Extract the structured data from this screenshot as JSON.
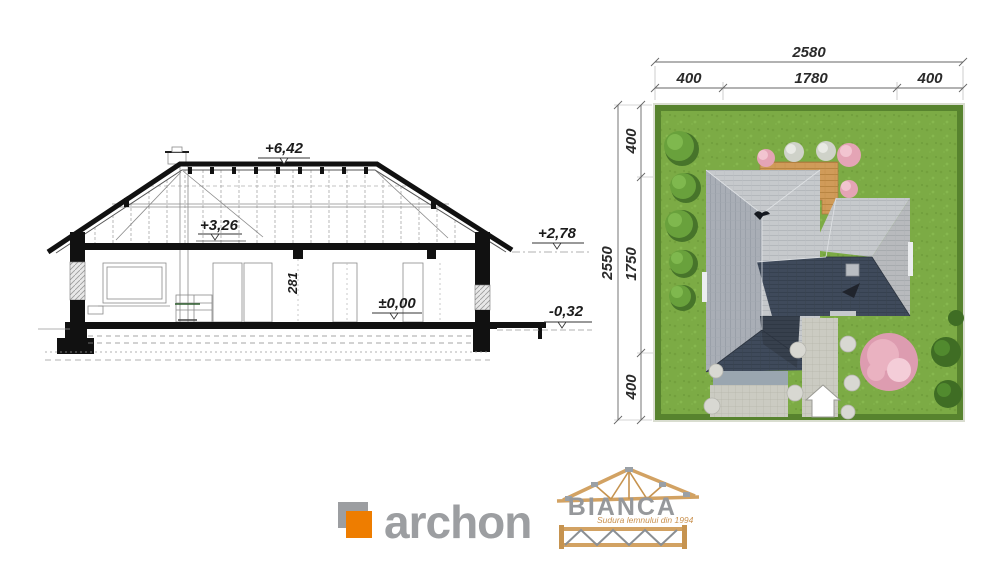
{
  "section": {
    "levels": {
      "ridge": "+6,42",
      "attic": "+3,26",
      "eaves": "+2,78",
      "floor": "±0,00",
      "ground": "-0,32"
    },
    "room_height": "281"
  },
  "site_plan": {
    "dim_top": {
      "total": "2580",
      "left": "400",
      "middle": "1780",
      "right": "400"
    },
    "dim_left": {
      "total": "2550",
      "top": "400",
      "middle": "1750",
      "bottom": "400"
    }
  },
  "branding": {
    "archon": {
      "name": "archon",
      "accent_color": "#ee7d00",
      "text_color": "#9c9ea1"
    },
    "bianca": {
      "name": "BIANCA",
      "tagline": "Sudura lemnului din 1994",
      "wood_color": "#d2a263"
    }
  },
  "colors": {
    "grass": "#7cab45",
    "hedge": "#57832e",
    "roof_light": "#c6c9cc",
    "roof_medium": "#a9aeb6",
    "roof_dark": "#3f4a5b",
    "deck_wood": "#d09b59",
    "paving": "#cbcbc2",
    "blossom_pink": "#eab2c1",
    "ink": "#1c1c1c"
  }
}
